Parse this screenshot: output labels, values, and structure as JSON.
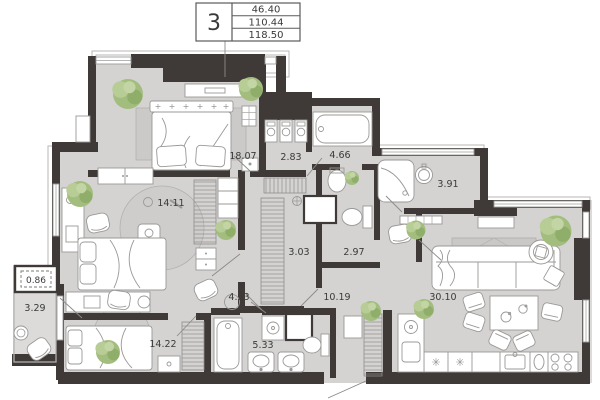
{
  "title_block": {
    "unit": "3",
    "areas": [
      "46.40",
      "110.44",
      "118.50"
    ]
  },
  "rooms": [
    {
      "name": "bedroom-1",
      "area": "18.07"
    },
    {
      "name": "storage",
      "area": "2.83"
    },
    {
      "name": "bathroom-1",
      "area": "4.66"
    },
    {
      "name": "bedroom-2",
      "area": "14.11"
    },
    {
      "name": "shower-room",
      "area": "3.91"
    },
    {
      "name": "walk-in-closet",
      "area": "3.03"
    },
    {
      "name": "wc",
      "area": "2.97"
    },
    {
      "name": "balcony-reduced",
      "area": "0.86"
    },
    {
      "name": "balcony",
      "area": "3.29"
    },
    {
      "name": "hall",
      "area": "4.93"
    },
    {
      "name": "corridor",
      "area": "10.19"
    },
    {
      "name": "living-kitchen",
      "area": "30.10"
    },
    {
      "name": "bedroom-3",
      "area": "14.22"
    },
    {
      "name": "bathroom-2",
      "area": "5.33"
    }
  ],
  "colors": {
    "wall": "#3f3a37",
    "floor": "#d4d3d2",
    "balcony_floor": "#dcdbda",
    "rug": "#c9c8c7",
    "plant": "#a3bd7f",
    "furniture_outline": "#9a9997",
    "background": "#ffffff"
  }
}
